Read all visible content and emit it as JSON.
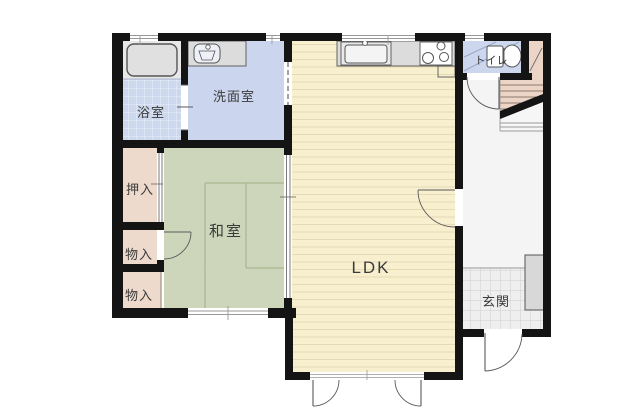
{
  "plan": {
    "rooms": {
      "bathroom": {
        "label": "浴室"
      },
      "washroom": {
        "label": "洗面室"
      },
      "toilet": {
        "label": "トイレ"
      },
      "closet": {
        "label": "押入"
      },
      "tatami_room": {
        "label": "和室"
      },
      "storage_upper": {
        "label": "物入"
      },
      "storage_lower": {
        "label": "物入"
      },
      "ldk": {
        "label": "LDK"
      },
      "entrance": {
        "label": "玄関"
      }
    },
    "colors": {
      "page_background": "#ffffff",
      "wall": "#141414",
      "bath_tile": "#ccd8ee",
      "tub_zone": "#e8e8e8",
      "washroom_floor": "#cbd6ee",
      "toilet_floor": "#ccd7ee",
      "ldk_floor": "#f8efcf",
      "tatami_floor": "#cdd6ba",
      "closet_floor": "#eedacd",
      "stairs_floor": "#ecd5c6",
      "hallway_floor": "#f4f4f4",
      "entrance_tile": "#efefef",
      "counter": "#dcdcdc",
      "cabinet": "#d8d8d8"
    }
  }
}
